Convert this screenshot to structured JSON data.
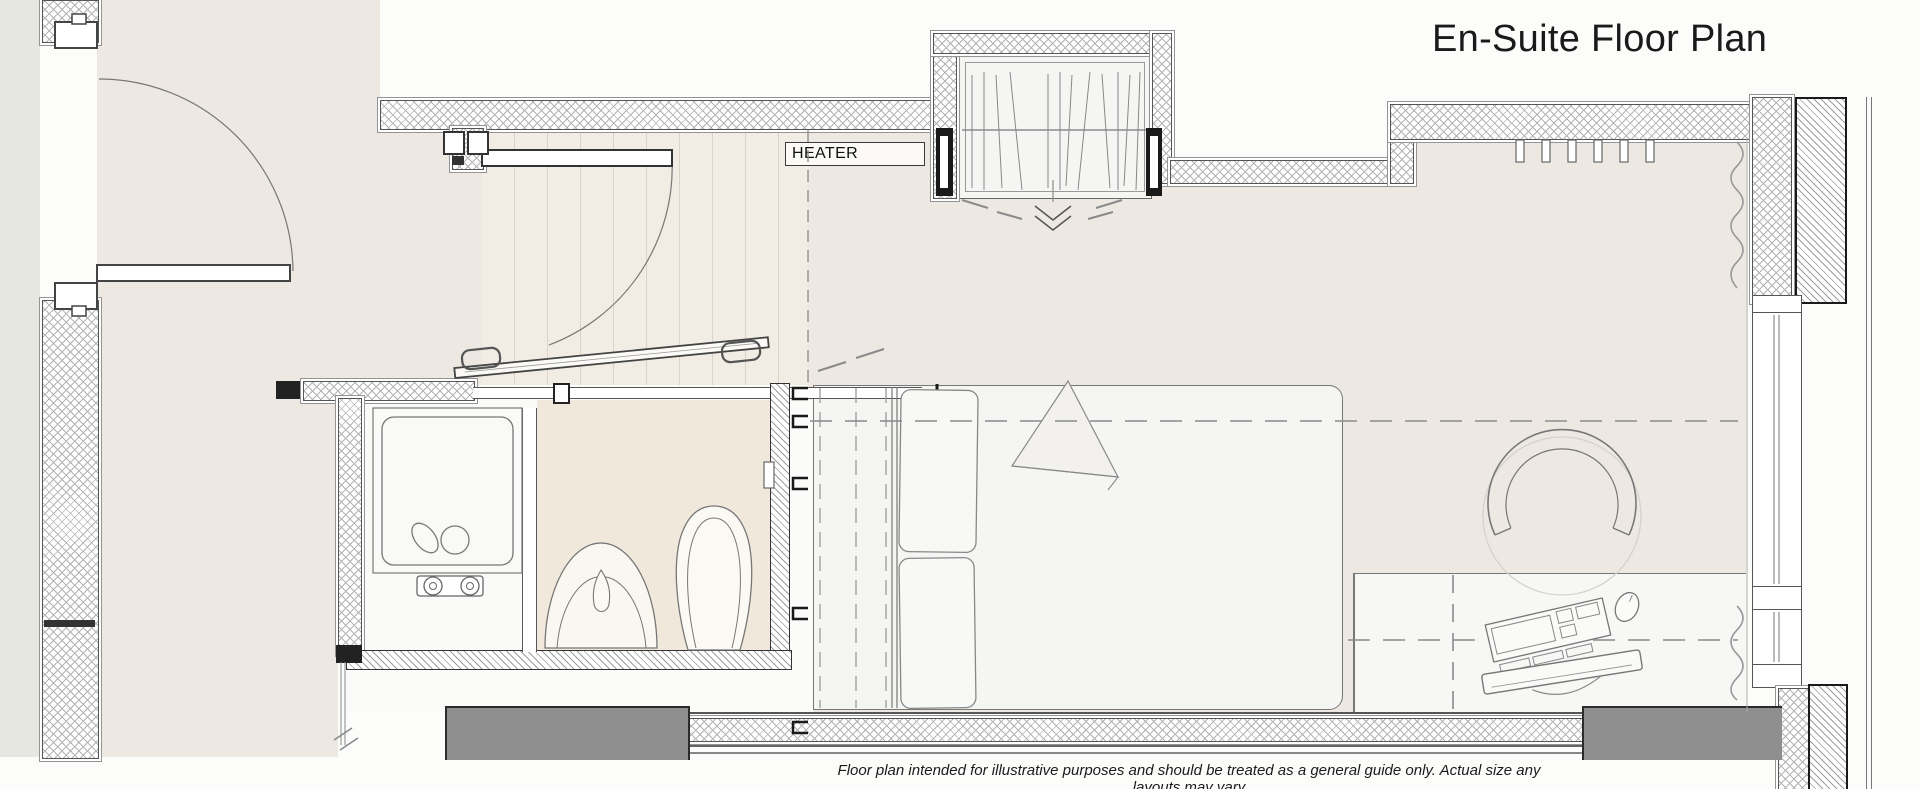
{
  "header": {
    "title": "En-Suite Floor Plan"
  },
  "plan": {
    "heater_label": "HEATER"
  },
  "footer": {
    "disclaimer": "Floor plan intended for illustrative purposes and should be treated as a general guide only.  Actual size any layouts may vary"
  },
  "colors": {
    "outside": "#FCFCFB",
    "floor_beige": "#EDE9E2",
    "plank_floor": "#F1ECE4",
    "bathroom_floor": "#EFE8DB",
    "furniture_white": "#F5F5F4",
    "left_strip": "#E7E7E1",
    "wall_line": "#555555",
    "block_gray": "#8F8F8F",
    "title_text": "#1A1A1A"
  }
}
